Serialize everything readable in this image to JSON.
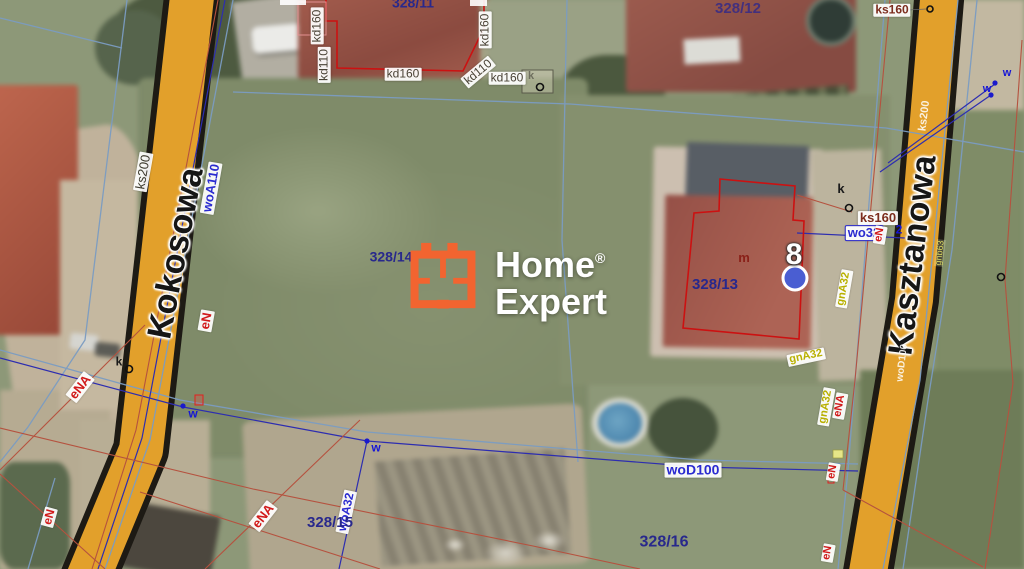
{
  "watermark": {
    "line1": "Home",
    "reg": "®",
    "line2": "Expert"
  },
  "streets": [
    {
      "name": "Kokosowa"
    },
    {
      "name": "Kasztanowa"
    }
  ],
  "marker_pin": {
    "number": "8"
  },
  "labels": [
    {
      "t": "ks200",
      "x": 143,
      "y": 172,
      "r": -80,
      "c": "ksdark bgw fs13",
      "n": "utility-label-ks200"
    },
    {
      "t": "woA110",
      "x": 211,
      "y": 188,
      "r": -80,
      "c": "navy bgw fs13",
      "n": "utility-label-woa110"
    },
    {
      "t": "eN",
      "x": 206,
      "y": 321,
      "r": -80,
      "c": "red bgw fs13",
      "n": "utility-label-en"
    },
    {
      "t": "eNA",
      "x": 80,
      "y": 387,
      "r": -52,
      "c": "red bgw fs13",
      "n": "utility-label-ena"
    },
    {
      "t": "eN",
      "x": 49,
      "y": 517,
      "r": -75,
      "c": "red bgw",
      "n": "utility-label-en"
    },
    {
      "t": "eNA",
      "x": 263,
      "y": 516,
      "r": -52,
      "c": "red bgw fs13",
      "n": "utility-label-ena"
    },
    {
      "t": "woA32",
      "x": 346,
      "y": 512,
      "r": -78,
      "c": "navy bgw",
      "n": "utility-label-woa32"
    },
    {
      "t": "328/15",
      "x": 330,
      "y": 523,
      "r": 0,
      "c": "parcel fs15",
      "n": "parcel-label-328-15"
    },
    {
      "t": "328/16",
      "x": 664,
      "y": 543,
      "r": 0,
      "c": "parcel fs16",
      "n": "parcel-label-328-16"
    },
    {
      "t": "woD100",
      "x": 693,
      "y": 470,
      "r": 0,
      "c": "navy bgw fs14",
      "n": "utility-label-wod100"
    },
    {
      "t": "328/14",
      "x": 391,
      "y": 257,
      "r": 0,
      "c": "parcel fs14",
      "n": "parcel-label-328-14"
    },
    {
      "t": "328/11",
      "x": 413,
      "y": 3,
      "r": 0,
      "c": "parcel fs14",
      "n": "parcel-label-328-11"
    },
    {
      "t": "328/12",
      "x": 738,
      "y": 9,
      "r": 0,
      "c": "parcel12 fs15",
      "n": "parcel-label-328-12"
    },
    {
      "t": "328/13",
      "x": 715,
      "y": 285,
      "r": 0,
      "c": "parcel fs15",
      "n": "parcel-label-328-13"
    },
    {
      "t": "m",
      "x": 744,
      "y": 258,
      "r": 0,
      "c": "mred",
      "n": "utility-label-m"
    },
    {
      "t": "kd160",
      "x": 317,
      "y": 26,
      "r": -90,
      "c": "kd bgw",
      "n": "utility-label-kd160"
    },
    {
      "t": "kd110",
      "x": 324,
      "y": 65,
      "r": -90,
      "c": "kd bgw",
      "n": "utility-label-kd110"
    },
    {
      "t": "kd160",
      "x": 403,
      "y": 74,
      "r": 0,
      "c": "kd bgw",
      "n": "utility-label-kd160"
    },
    {
      "t": "kd110",
      "x": 478,
      "y": 72,
      "r": -40,
      "c": "kd bgw",
      "n": "utility-label-kd110"
    },
    {
      "t": "kd160",
      "x": 507,
      "y": 78,
      "r": 0,
      "c": "kd bgw",
      "n": "utility-label-kd160"
    },
    {
      "t": "kd160",
      "x": 485,
      "y": 30,
      "r": -90,
      "c": "kd bgw",
      "n": "utility-label-kd160"
    },
    {
      "t": "ks160",
      "x": 892,
      "y": 10,
      "r": 0,
      "c": "ks bgw",
      "n": "utility-label-ks160"
    },
    {
      "t": "ks160",
      "x": 878,
      "y": 218,
      "r": 0,
      "c": "ks bgw fs13",
      "n": "utility-label-ks160"
    },
    {
      "t": "wo32",
      "x": 864,
      "y": 233,
      "r": 0,
      "c": "navy bgw wo32box fs13",
      "n": "utility-label-wo32"
    },
    {
      "t": "2",
      "x": 899,
      "y": 230,
      "r": 0,
      "c": "wblue fs12",
      "n": "utility-label-2"
    },
    {
      "t": "eN",
      "x": 880,
      "y": 235,
      "r": -80,
      "c": "red bgw fs11",
      "n": "utility-label-en"
    },
    {
      "t": "gnA32",
      "x": 844,
      "y": 289,
      "r": -80,
      "c": "olive bgw fs11",
      "n": "utility-label-gna32"
    },
    {
      "t": "gnA32",
      "x": 806,
      "y": 357,
      "r": -12,
      "c": "olive bgw fs11",
      "n": "utility-label-gna32"
    },
    {
      "t": "gnA32",
      "x": 826,
      "y": 407,
      "r": -80,
      "c": "olive bgw fs11",
      "n": "utility-label-gna32"
    },
    {
      "t": "eNA",
      "x": 840,
      "y": 406,
      "r": -80,
      "c": "red bgw fs11",
      "n": "utility-label-ena"
    },
    {
      "t": "eN",
      "x": 833,
      "y": 472,
      "r": -80,
      "c": "red bgw fs11",
      "n": "utility-label-en"
    },
    {
      "t": "eN",
      "x": 828,
      "y": 553,
      "r": -80,
      "c": "red bgw fs11",
      "n": "utility-label-en"
    },
    {
      "t": "w",
      "x": 1007,
      "y": 74,
      "r": 0,
      "c": "wblue fs11",
      "n": "marker-label-w"
    },
    {
      "t": "w",
      "x": 987,
      "y": 90,
      "r": 0,
      "c": "wblue fs11",
      "n": "marker-label-w"
    },
    {
      "t": "w",
      "x": 193,
      "y": 414,
      "r": 0,
      "c": "wblue",
      "n": "marker-label-w"
    },
    {
      "t": "w",
      "x": 376,
      "y": 448,
      "r": 0,
      "c": "wblue",
      "n": "marker-label-w"
    },
    {
      "t": "k",
      "x": 119,
      "y": 362,
      "r": 0,
      "c": "kblk",
      "n": "marker-label-k"
    },
    {
      "t": "k",
      "x": 841,
      "y": 189,
      "r": 0,
      "c": "kblk fs13",
      "n": "marker-label-k"
    },
    {
      "t": "k",
      "x": 531,
      "y": 77,
      "r": 0,
      "c": "kgray",
      "n": "marker-label-k"
    },
    {
      "t": "ks200",
      "x": 925,
      "y": 116,
      "r": -83,
      "c": "wfaint",
      "n": "road-label-ks200"
    },
    {
      "t": "gnb63",
      "x": 940,
      "y": 253,
      "r": -83,
      "c": "gfaint",
      "n": "road-label-gnb63"
    },
    {
      "t": "woD100",
      "x": 903,
      "y": 363,
      "r": -83,
      "c": "wfaint fs10",
      "n": "road-label-wod100"
    }
  ],
  "colors": {
    "road": "#e2a02b",
    "road_edge": "#1d1a14",
    "line_blue": "#7b9cc2",
    "line_navy": "#2d2db0",
    "line_red": "#b5523f",
    "outline_red": "#cc1111",
    "dot_blue": "#1a1acc",
    "pin_blue": "#4a5ed2",
    "label_red": "#d11a1a",
    "label_navy": "#2a2ad0",
    "label_olive": "#b8b000",
    "parcel_navy": "#28288c",
    "logo_orange": "#f26430"
  }
}
